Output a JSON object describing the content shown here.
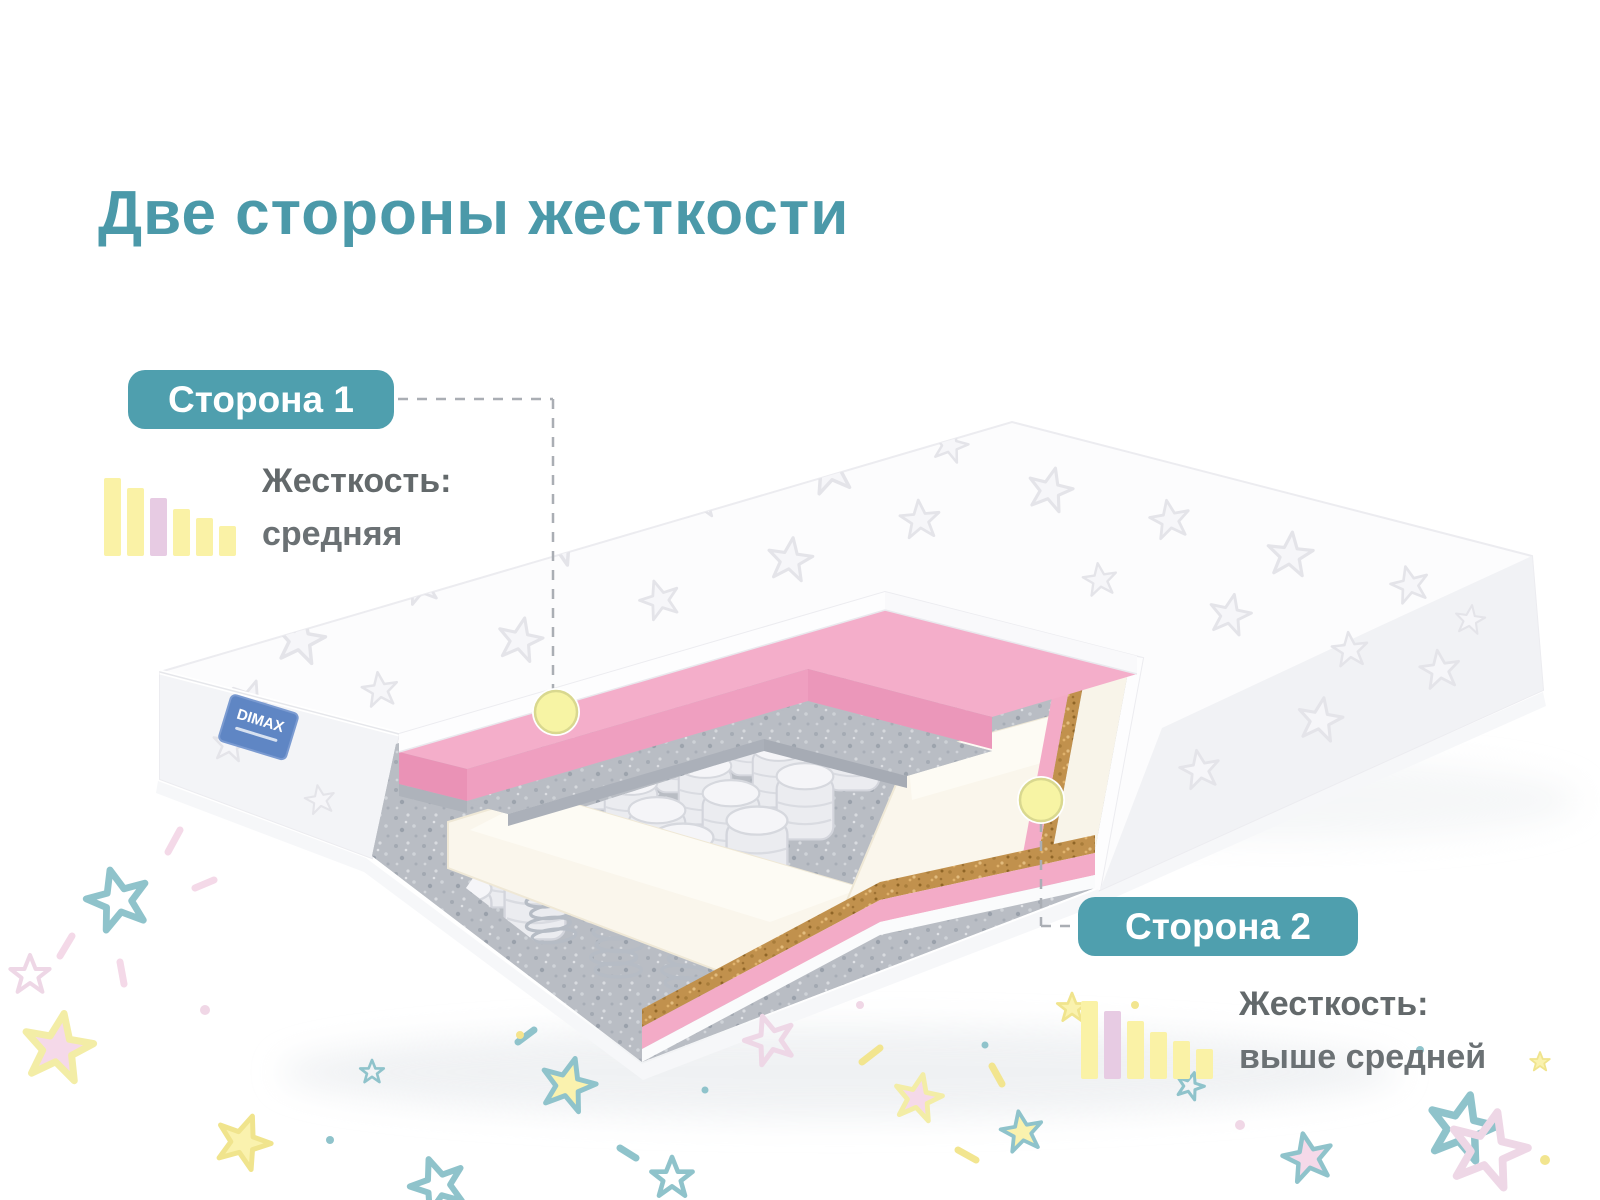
{
  "title": "Две стороны жесткости",
  "sides": {
    "side1": {
      "badge": "Сторона 1",
      "firmness_label": "Жесткость:",
      "firmness_value": "средняя",
      "scale_position": 3,
      "levels_total": 6
    },
    "side2": {
      "badge": "Сторона 2",
      "firmness_label": "Жесткость:",
      "firmness_value": "выше средней",
      "scale_position": 2,
      "levels_total": 6
    }
  },
  "mattress": {
    "brand_label": "DIMAX"
  },
  "colors": {
    "accent_teal": "#4f9fae",
    "text_gray": "#63696b",
    "bar_yellow": "#faf2a6",
    "bar_pink": "#e7cbe3",
    "pink_layer": "#f4aeca",
    "marker_yellow": "#f7f4a4"
  }
}
